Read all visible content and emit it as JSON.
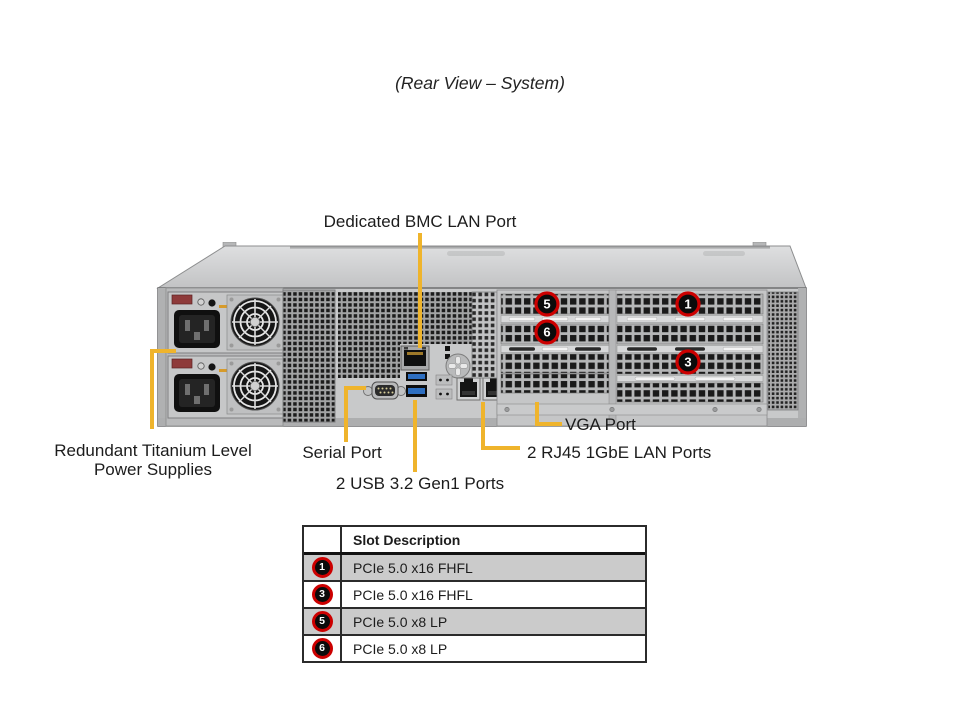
{
  "figure": {
    "title": "(Rear View – System)"
  },
  "callouts": {
    "bmc_lan": "Dedicated BMC LAN Port",
    "power_supplies_line1": "Redundant Titanium Level",
    "power_supplies_line2": "Power Supplies",
    "serial": "Serial Port",
    "usb": "2 USB 3.2 Gen1 Ports",
    "lan": "2 RJ45 1GbE LAN Ports",
    "vga": "VGA Port"
  },
  "chassis_badges": {
    "slot1": "1",
    "slot3": "3",
    "slot5": "5",
    "slot6": "6"
  },
  "slot_table": {
    "header": "Slot Description",
    "rows": [
      {
        "slot": "1",
        "description": "PCIe 5.0 x16 FHFL"
      },
      {
        "slot": "3",
        "description": "PCIe 5.0 x16 FHFL"
      },
      {
        "slot": "5",
        "description": "PCIe 5.0 x8 LP"
      },
      {
        "slot": "6",
        "description": "PCIe 5.0 x8 LP"
      }
    ]
  },
  "colors": {
    "callout_line": "#EFB42C",
    "badge_ring": "#CC0000",
    "badge_fill": "#0B0B0B",
    "table_row_shade": "#CBCBCB",
    "usb_port_blue": "#2E6FC1",
    "vga_port_blue": "#3F62B5"
  }
}
